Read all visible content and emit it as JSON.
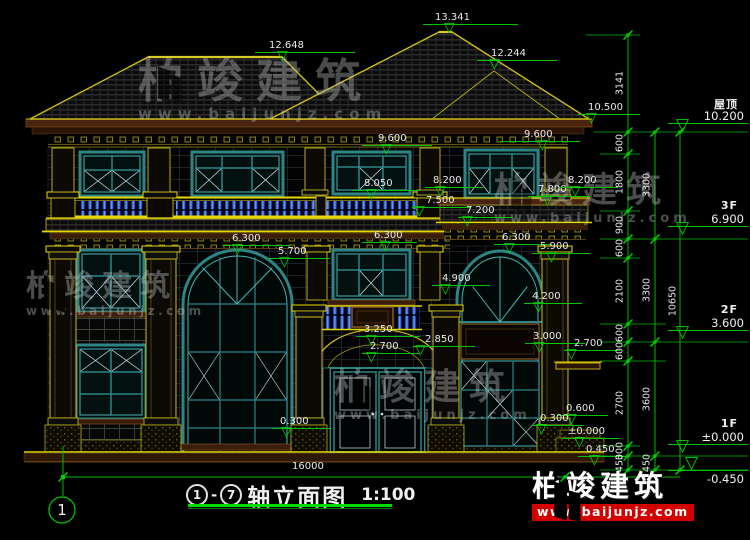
{
  "drawing": {
    "title": {
      "axis_start": "1",
      "dash": "-",
      "axis_end": "7",
      "name": "轴立面图",
      "scale": "1:100"
    },
    "axis_bubble": "1",
    "bottom_dimension": "16000",
    "symbols": {
      "level_triangle": "▽"
    },
    "levels": [
      "12.648",
      "13.341",
      "12.244",
      "10.500",
      "9.600",
      "9.600",
      "8.050",
      "8.200",
      "7.500",
      "7.800",
      "8.200",
      "7.200",
      "6.300",
      "6.300",
      "6.300",
      "5.900",
      "5.700",
      "4.900",
      "4.200",
      "3.250",
      "3.000",
      "2.850",
      "2.700",
      "2.700",
      "0.600",
      "0.300",
      "0.300",
      "±0.000",
      "0.450"
    ],
    "floor_marks": [
      {
        "label": "屋顶",
        "value": "10.200"
      },
      {
        "label": "3F",
        "value": "6.900"
      },
      {
        "label": "2F",
        "value": "3.600"
      },
      {
        "label": "1F",
        "value": "±0.000"
      },
      {
        "label": "",
        "value": "-0.450"
      }
    ],
    "chains": {
      "c1": [
        "3141",
        "600",
        "1800",
        "900",
        "600",
        "2100",
        "600",
        "600",
        "2700",
        "300",
        "450"
      ],
      "c2": [
        "3300",
        "3300",
        "3600",
        "450"
      ],
      "c3": [
        "10650"
      ]
    },
    "colors": {
      "annotation_green": "#00c400",
      "structure_yellow": "#cdbd18",
      "window_teal": "#2e8585",
      "baluster_blue": "#2b55c8",
      "logo_red": "#d40000"
    }
  },
  "watermark": {
    "brand": "柏竣建筑",
    "url": "www.baijunjz.com"
  },
  "logo": {
    "brand": "柏竣建筑",
    "url": "www.baijunjz.com"
  }
}
